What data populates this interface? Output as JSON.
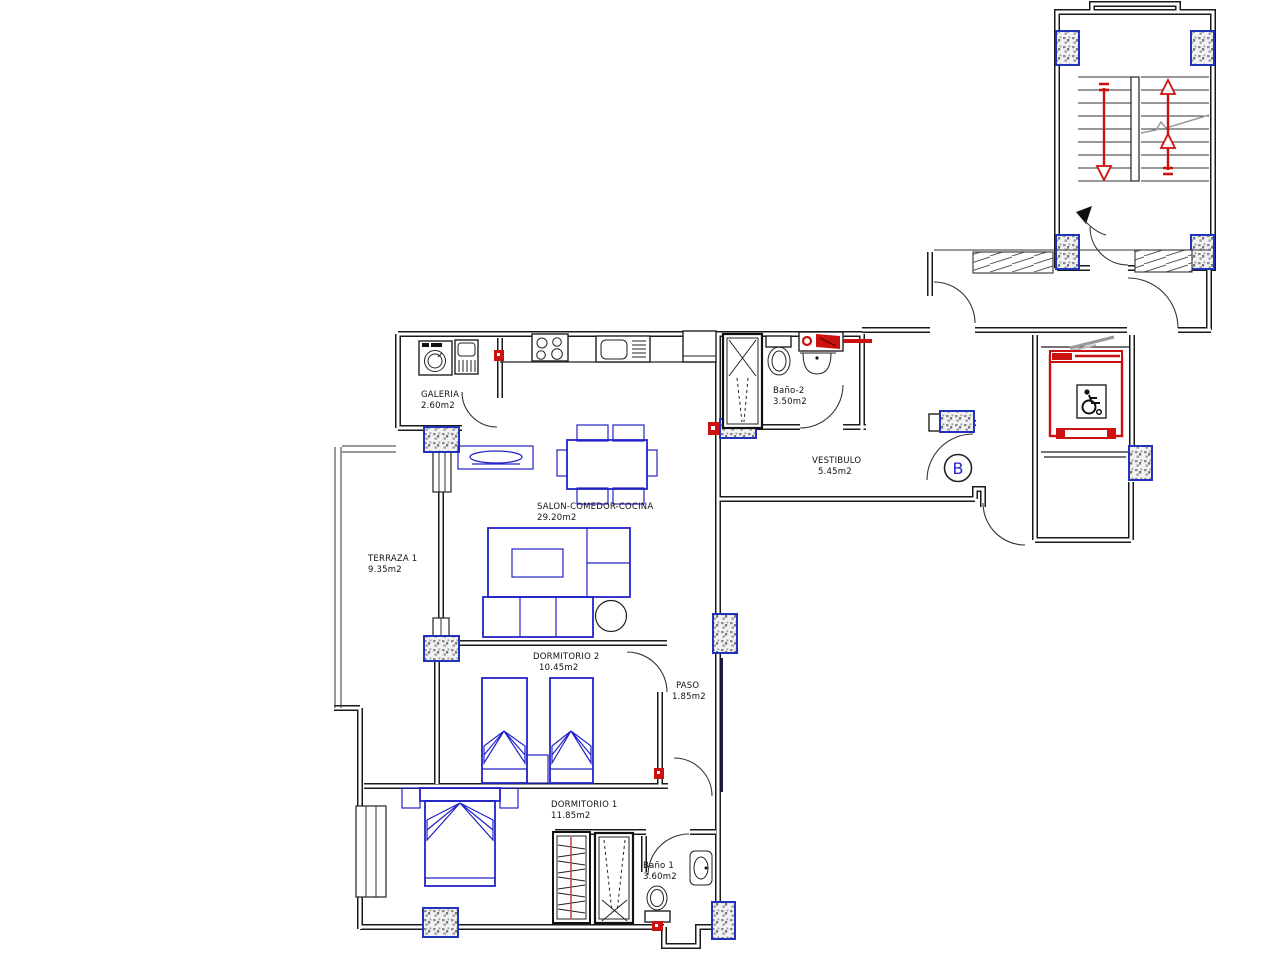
{
  "document": {
    "type": "apartment-floor-plan",
    "unit_circle_label": "B"
  },
  "rooms": [
    {
      "id": "galeria",
      "name": "GALERIA",
      "area": "2.60m2"
    },
    {
      "id": "terraza",
      "name": "TERRAZA 1",
      "area": "9.35m2"
    },
    {
      "id": "salon",
      "name": "SALON-COMEDOR-COCINA",
      "area": "29.20m2"
    },
    {
      "id": "dormitorio2",
      "name": "DORMITORIO 2",
      "area": "10.45m2"
    },
    {
      "id": "paso",
      "name": "PASO",
      "area": "1.85m2"
    },
    {
      "id": "dormitorio1",
      "name": "DORMITORIO 1",
      "area": "11.85m2"
    },
    {
      "id": "bano1",
      "name": "Baño 1",
      "area": "3.60m2"
    },
    {
      "id": "bano2",
      "name": "Baño-2",
      "area": "3.50m2"
    },
    {
      "id": "vestibulo",
      "name": "VESTIBULO",
      "area": "5.45m2"
    }
  ],
  "colors": {
    "walls": "#1a1a1a",
    "furniture_blue": "#2323c8",
    "accent_red": "#cc1111",
    "pillar_blue": "#2233bb",
    "speckle_gray": "#8a8a8a"
  }
}
